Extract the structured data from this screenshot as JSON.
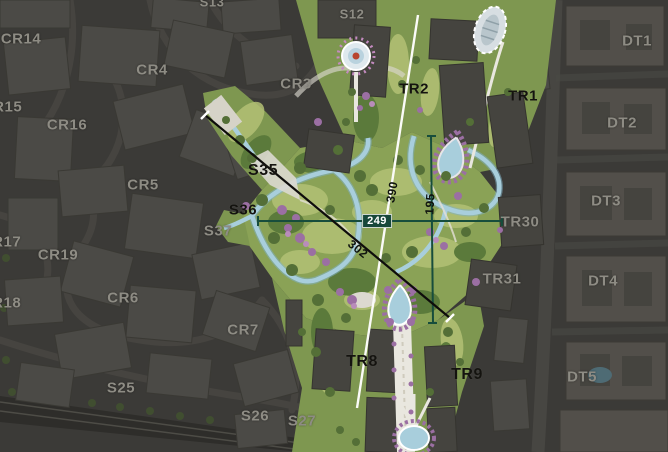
{
  "map": {
    "title": "masterplan-aerial-overlay",
    "zone_labels": [
      {
        "id": "S13",
        "text": "S13"
      },
      {
        "id": "S12",
        "text": "S12"
      },
      {
        "id": "CR14",
        "text": "CR14"
      },
      {
        "id": "DT1",
        "text": "DT1"
      },
      {
        "id": "CR4",
        "text": "CR4"
      },
      {
        "id": "CR3",
        "text": "CR3"
      },
      {
        "id": "TR2",
        "text": "TR2"
      },
      {
        "id": "TR1",
        "text": "TR1"
      },
      {
        "id": "CR15",
        "text": "CR15"
      },
      {
        "id": "CR16",
        "text": "CR16"
      },
      {
        "id": "DT2",
        "text": "DT2"
      },
      {
        "id": "S35",
        "text": "S35"
      },
      {
        "id": "CR5",
        "text": "CR5"
      },
      {
        "id": "DT3",
        "text": "DT3"
      },
      {
        "id": "S36",
        "text": "S36"
      },
      {
        "id": "TR30",
        "text": "TR30"
      },
      {
        "id": "S37",
        "text": "S37"
      },
      {
        "id": "CR17",
        "text": "CR17"
      },
      {
        "id": "CR19",
        "text": "CR19"
      },
      {
        "id": "DT4",
        "text": "DT4"
      },
      {
        "id": "TR31",
        "text": "TR31"
      },
      {
        "id": "CR18",
        "text": "CR18"
      },
      {
        "id": "CR6",
        "text": "CR6"
      },
      {
        "id": "CR7",
        "text": "CR7"
      },
      {
        "id": "TR8",
        "text": "TR8"
      },
      {
        "id": "TR9",
        "text": "TR9"
      },
      {
        "id": "DT5",
        "text": "DT5"
      },
      {
        "id": "S25",
        "text": "S25"
      },
      {
        "id": "S26",
        "text": "S26"
      },
      {
        "id": "S27",
        "text": "S27"
      }
    ],
    "measurements": {
      "d390": "390",
      "d195": "195",
      "d302": "302",
      "d249": "249"
    },
    "colors": {
      "park_green": "#85994f",
      "lawn_light": "#b5c17a",
      "water_blue": "#a8cedc",
      "flower_purple": "#9b6fa3",
      "measure_green": "#174d3c",
      "dim_city": "#3b3a37",
      "dim_building": "#4b4a46",
      "path_white": "#e9e7df"
    }
  }
}
